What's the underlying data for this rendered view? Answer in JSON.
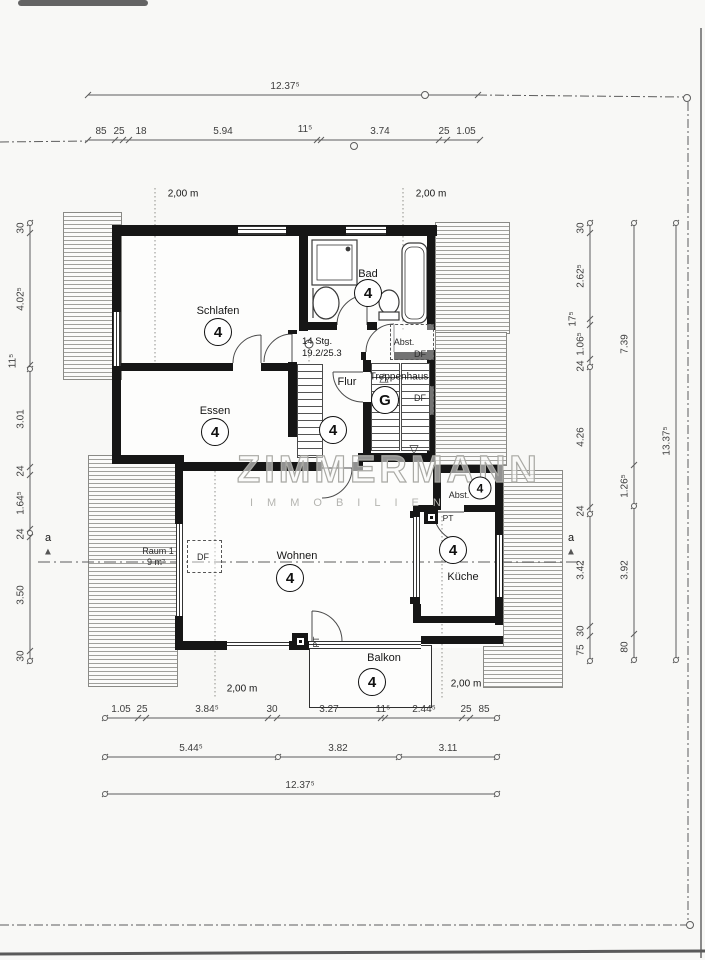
{
  "watermark": {
    "line1": "ZIMMERMANN",
    "line2": "IMMOBILIEN"
  },
  "rooms": {
    "schlafen": {
      "label": "Schlafen",
      "badge": "4"
    },
    "bad": {
      "label": "Bad",
      "badge": "4"
    },
    "essen": {
      "label": "Essen",
      "badge": "4"
    },
    "flur": {
      "label": "Flur",
      "badge": "4"
    },
    "treppenhaus": {
      "label": "Treppenhaus",
      "badge": "G"
    },
    "wohnen": {
      "label": "Wohnen",
      "badge": "4"
    },
    "kueche": {
      "label": "Küche",
      "badge": "4"
    },
    "balkon": {
      "label": "Balkon",
      "badge": "4"
    },
    "abst_upper": {
      "label": "Abst."
    },
    "abst_lower": {
      "label": "Abst.",
      "badge": "4"
    },
    "raum1": {
      "label": "Raum 1",
      "area": "9 m²"
    }
  },
  "annotations": {
    "stairs_line1": "14 Stg.",
    "stairs_line2": "19.2/25.3",
    "df": "DF",
    "pt": "PT",
    "height_marker": "2,00 m",
    "section_marker": "a"
  },
  "icons": {
    "up_triangle": "△",
    "down_triangle": "▽",
    "marker_triangle": "▲"
  },
  "dimensions": {
    "top_total": "12.37⁵",
    "top_segments": [
      "85",
      "25",
      "18",
      "5.94",
      "11⁵",
      "3.74",
      "25",
      "1.05"
    ],
    "left_segments": [
      "30",
      "4.02⁵",
      "11⁵",
      "3.01",
      "24",
      "1.64⁵",
      "24",
      "3.50",
      "30"
    ],
    "right_segments": [
      "30",
      "2.62⁵",
      "17⁵",
      "1.06⁵",
      "24",
      "4.26",
      "24",
      "3.42",
      "30",
      "75"
    ],
    "right_groups": [
      "7.39",
      "1.26⁵",
      "3.92",
      "80"
    ],
    "right_total": "13.37⁵",
    "bottom_segments": [
      "1.05",
      "25",
      "3.84⁵",
      "30",
      "3.27",
      "11⁵",
      "2.44⁵",
      "25",
      "85"
    ],
    "bottom_groups": [
      "5.44⁵",
      "3.82",
      "3.11"
    ],
    "bottom_total": "12.37⁵"
  }
}
